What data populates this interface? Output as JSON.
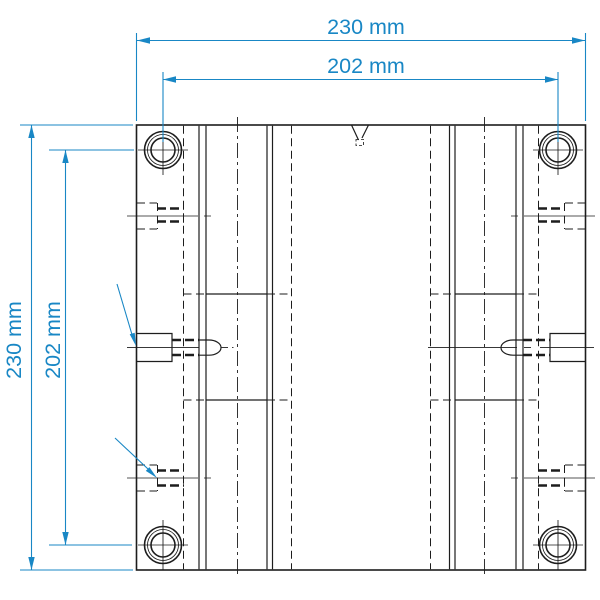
{
  "drawing": {
    "kind": "engineering-drawing-top-view",
    "units": "mm"
  },
  "dimensions": {
    "top_outer": {
      "label": "230 mm",
      "value": 230,
      "unit": "mm"
    },
    "top_inner": {
      "label": "202 mm",
      "value": 202,
      "unit": "mm"
    },
    "left_outer": {
      "label": "230 mm",
      "value": 230,
      "unit": "mm"
    },
    "left_inner": {
      "label": "202 mm",
      "value": 202,
      "unit": "mm"
    }
  },
  "colors": {
    "dimension": "#1987c5",
    "line": "#1d1d1d",
    "background": "#ffffff"
  }
}
